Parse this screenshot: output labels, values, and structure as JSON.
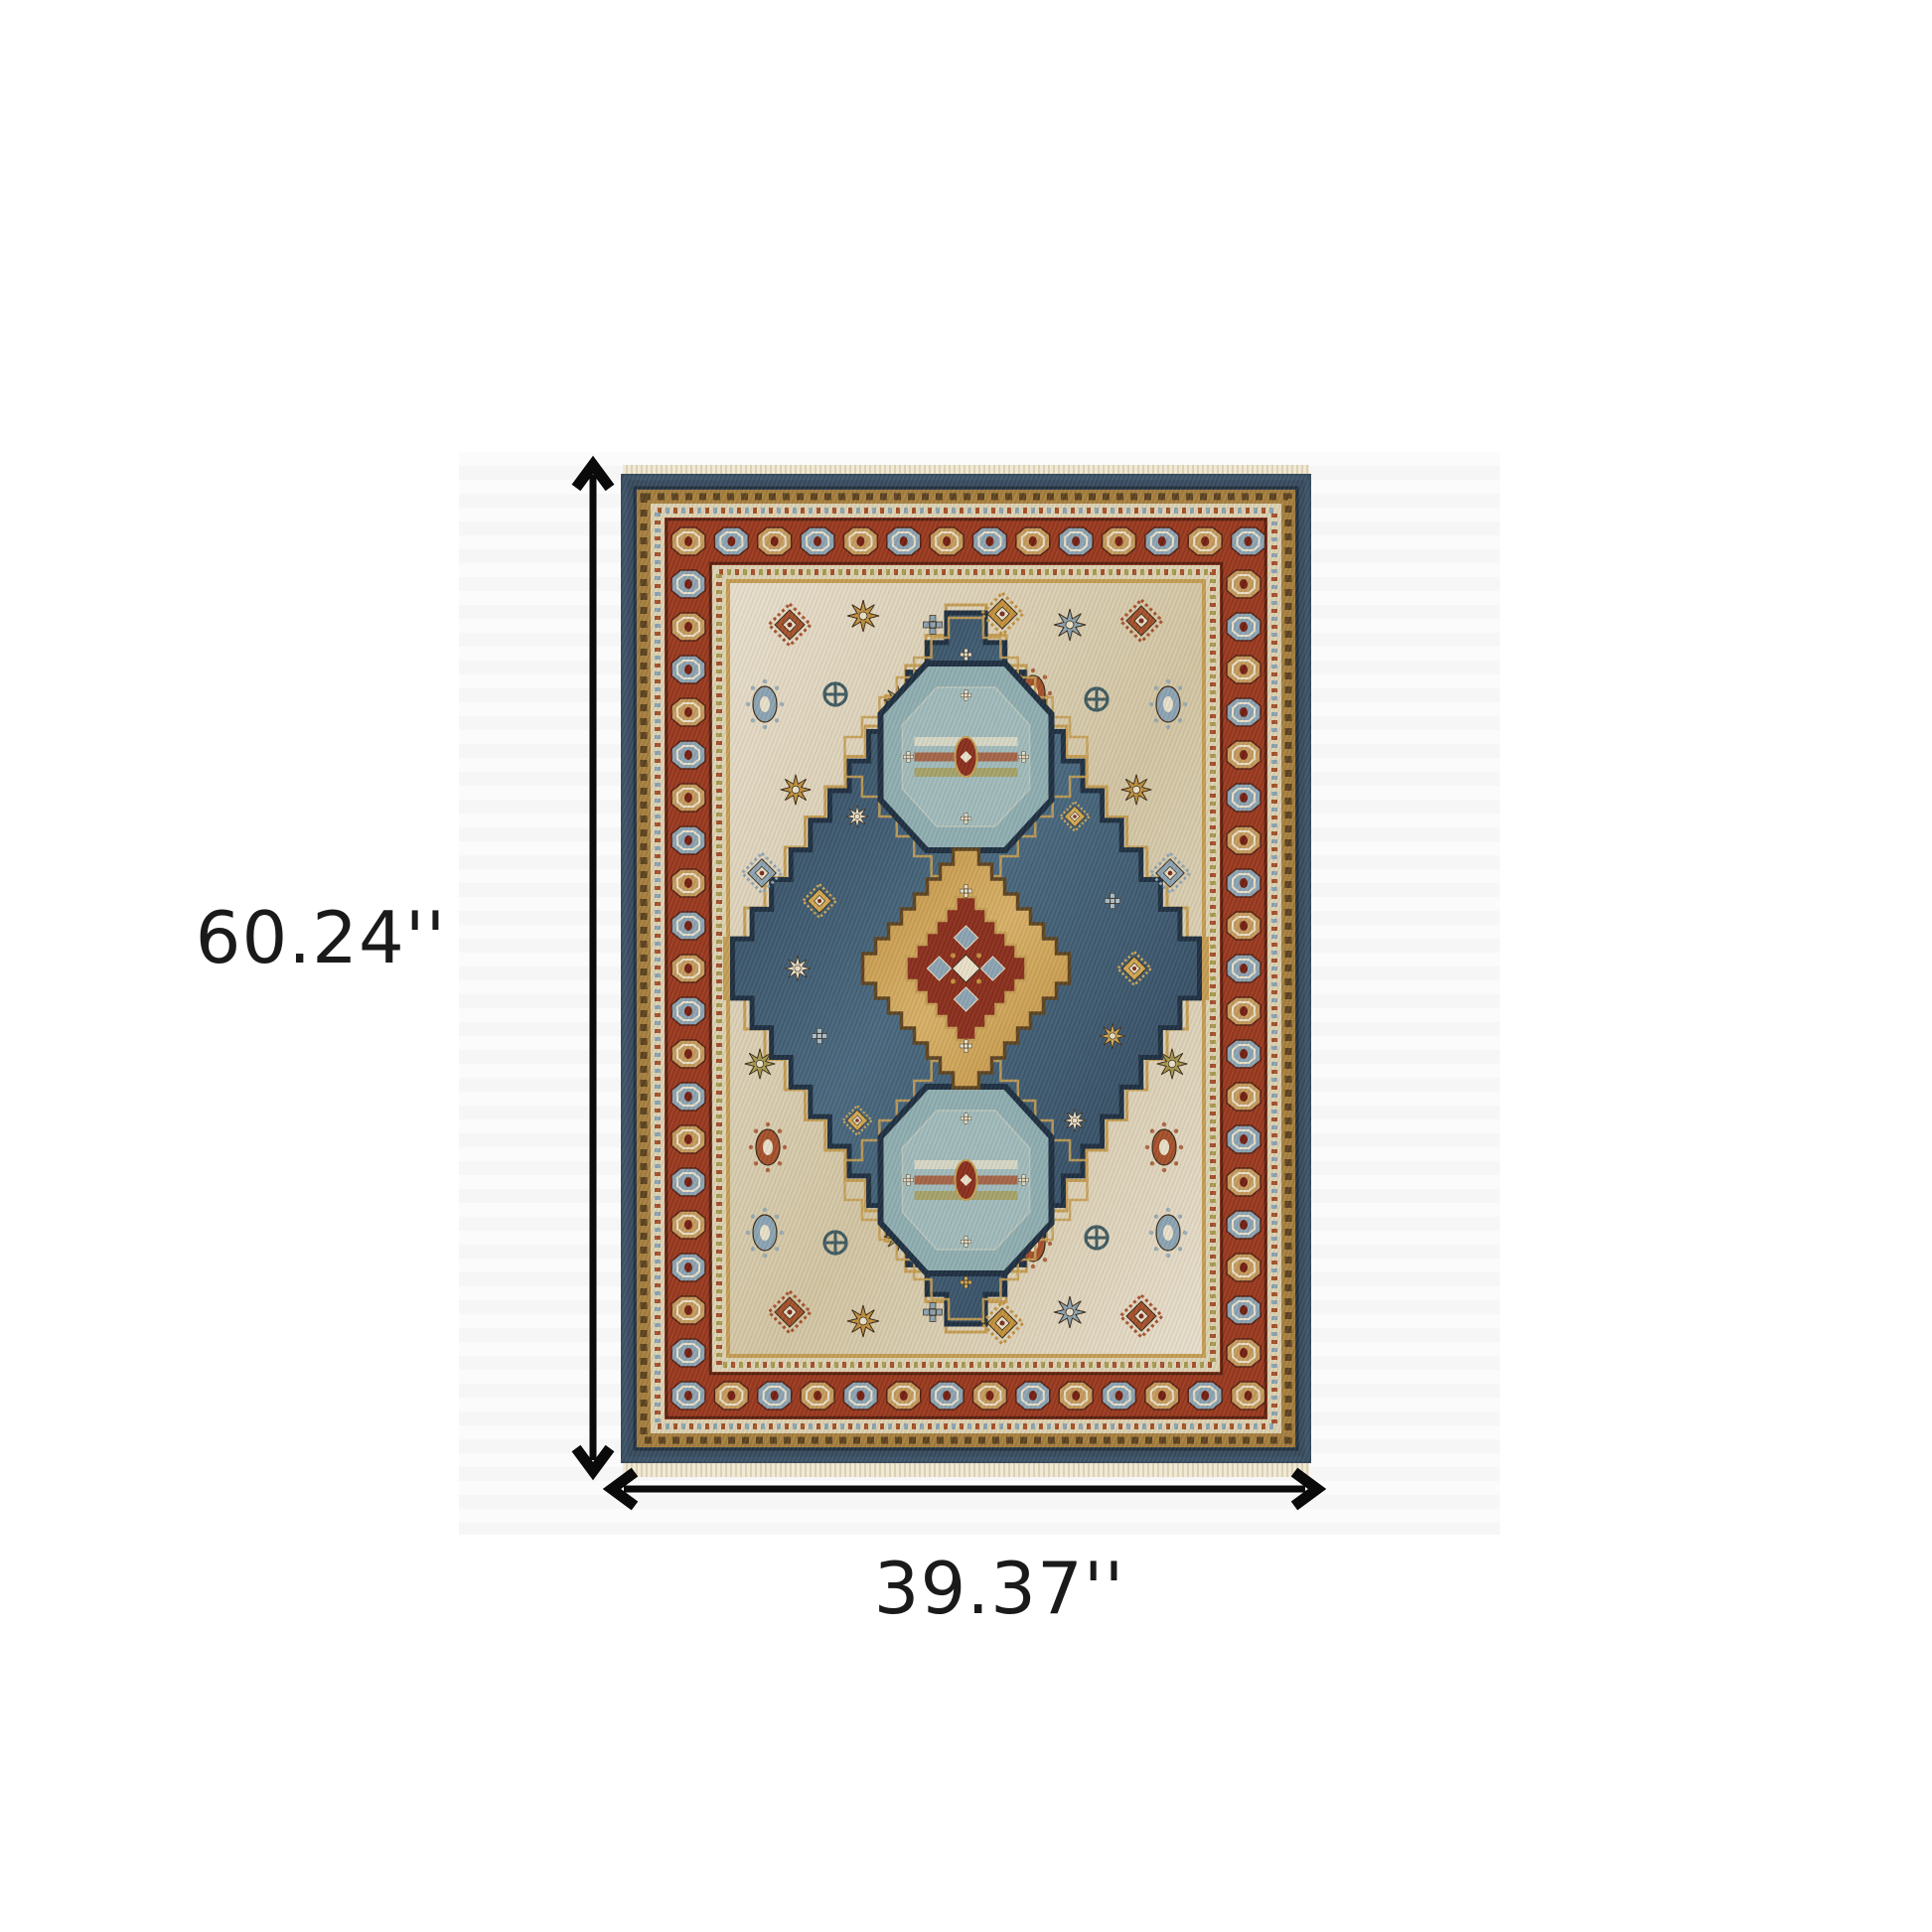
{
  "page": {
    "background": "#ffffff"
  },
  "dimensions": {
    "height": {
      "label": "60.24''"
    },
    "width": {
      "label": "39.37''"
    },
    "arrow_color": "#0a0a0a",
    "label_color": "#1a1a1a"
  },
  "rug": {
    "palette": {
      "outer_navy": "#3c4f63",
      "outer_navy_dark": "#243240",
      "gold_border": "#a8803e",
      "gold_dark": "#5d431f",
      "gold_bright": "#c59d52",
      "ivory_guard": "#ddd2b2",
      "rust": "#99381d",
      "rust_dark": "#561f10",
      "steel_blue": "#8ca3b2",
      "tan_medallion": "#c59a5c",
      "ivory_field": "#e8decc",
      "ivory_streak": "#d3c5a2",
      "field_navy": "#2c4156",
      "field_navy_dark": "#1e2f40",
      "field_blue": "#49687e",
      "teal_medallion": "#8fadb0",
      "teal_light": "#b3c8c4",
      "gold_medallion": "#c08f3f",
      "red_center": "#8a2e1b",
      "cream": "#e9e0c8",
      "olive": "#a89a4e",
      "fringe": "#f0e9d6"
    }
  }
}
